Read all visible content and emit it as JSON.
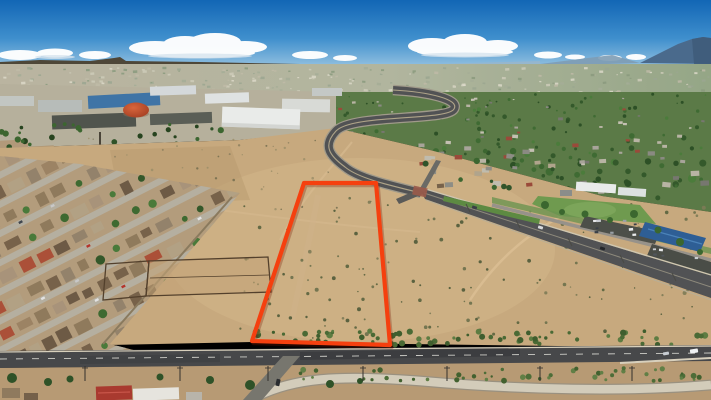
{
  "meta": {
    "description": "Aerial drone photograph of a vacant desert land parcel outlined in red, bordered by a residential neighborhood, industrial buildings, curving boulevards and a mountain on the horizon"
  },
  "colors": {
    "sky_top": "#1266b5",
    "sky_mid": "#3f8fcd",
    "sky_horizon": "#9cc6e2",
    "mountain": "#4a6a8c",
    "mountain_shade": "#3d5a78",
    "foothill": "#7e9cb4",
    "mesa": "#4e4738",
    "haze_left": "#b3ab92",
    "haze_right": "#879a74",
    "green_zone": "#5b7a47",
    "industrial_base": "#b6b09c",
    "dirt": "#c7a97e",
    "dirt_light": "#d5b88c",
    "below_dirt": "#b79a74",
    "road_main": "#47484a",
    "road_blvd": "#515254",
    "road_light": "#77766e",
    "median_green": "#5d8a42",
    "park_green": "#6f9a4f",
    "solar_blue": "#2e5e95",
    "dome_light": "#d8653c",
    "dome_dark": "#a03c20",
    "channel": "#d3ccba",
    "channel_edge": "#9a9180",
    "neighborhood_base": "#b39c7c",
    "wall": "#8a7a5e",
    "corral_fence": "#53402c",
    "red_outline": "#f5400f",
    "red_outline_shadow": "#7a1a05"
  },
  "parcel": {
    "points": "304,183 376,183 390,345 252,341",
    "stroke_width": 4.2
  },
  "neighborhood": {
    "seed": 7,
    "rows": 9,
    "v0": 176,
    "spacing": 26,
    "u0": -20,
    "u1": 310,
    "streetH": 6.5,
    "houseH": 13,
    "treeProb": 0.22,
    "carProb": 0.15,
    "street_color": "#b5afa0",
    "palette": [
      "#8f7a5c",
      "#9c8364",
      "#77624a",
      "#b2a184",
      "#6d5a45",
      "#a8937a",
      "#93826b",
      "#ab5038"
    ],
    "trees": [
      "#3e6a31",
      "#34582a",
      "#4a7a3a"
    ],
    "cars": [
      "#e2e2e2",
      "#b5342a",
      "#f0f0ee",
      "#40464e",
      "#c8c8c8"
    ]
  },
  "layers": [
    {
      "id": "city-specks",
      "kind": "rect",
      "seed": 11,
      "count": 230,
      "x": 0,
      "y": 68,
      "w": 711,
      "h": 26,
      "smin": 0.8,
      "smax": 2.2,
      "palette": [
        "#c9c5af",
        "#9aa287",
        "#b9b19a",
        "#7a8c6a",
        "#d9d5c1",
        "#8e9a80"
      ],
      "op": 0.85
    },
    {
      "id": "green-trees",
      "kind": "circle",
      "seed": 21,
      "count": 175,
      "x": 336,
      "y": 94,
      "w": 375,
      "h": 112,
      "smin": 1.1,
      "smax": 3.4,
      "palette": [
        "#3f6b33",
        "#34592b",
        "#4b7c3b",
        "#2d5026"
      ],
      "op": 1,
      "grow": true
    },
    {
      "id": "green-roofs",
      "kind": "rect",
      "seed": 31,
      "count": 85,
      "x": 340,
      "y": 98,
      "w": 371,
      "h": 104,
      "smin": 1.6,
      "smax": 3.6,
      "palette": [
        "#a8a49a",
        "#c4c0b2",
        "#8a8a82",
        "#9a4a3a",
        "#b8b4a4",
        "#777770"
      ],
      "op": 1,
      "grow": true
    },
    {
      "id": "ind-trees",
      "kind": "circle",
      "seed": 121,
      "count": 28,
      "x": 0,
      "y": 124,
      "w": 235,
      "h": 24,
      "smin": 1.4,
      "smax": 3.2,
      "palette": [
        "#2f5228",
        "#3c6630",
        "#27441f"
      ],
      "op": 1
    },
    {
      "id": "left-dirt-specks",
      "kind": "circle",
      "seed": 71,
      "count": 55,
      "x": 70,
      "y": 138,
      "w": 270,
      "h": 74,
      "smin": 0.5,
      "smax": 1.4,
      "palette": [
        "#8a7d5c",
        "#6f6a4c",
        "#9a8d68"
      ],
      "op": 0.8
    },
    {
      "id": "shrubs-main",
      "kind": "circle",
      "seed": 41,
      "count": 155,
      "x": 240,
      "y": 198,
      "w": 468,
      "h": 142,
      "smin": 0.6,
      "smax": 2.0,
      "palette": [
        "#6b704b",
        "#59633e",
        "#7d7b57",
        "#4f5a38"
      ],
      "op": 0.9
    },
    {
      "id": "shrub-line",
      "kind": "circle",
      "seed": 51,
      "count": 72,
      "x": 252,
      "y": 331,
      "w": 456,
      "h": 14,
      "smin": 1.4,
      "smax": 3.4,
      "palette": [
        "#4a6a35",
        "#3f5e2e",
        "#5d7c42"
      ],
      "op": 1
    },
    {
      "id": "shrubs-below",
      "kind": "circle",
      "seed": 61,
      "count": 48,
      "x": 298,
      "y": 368,
      "w": 410,
      "h": 13,
      "smin": 1.2,
      "smax": 3.0,
      "palette": [
        "#4d6d38",
        "#42612f",
        "#617f46"
      ],
      "op": 1
    },
    {
      "id": "mid-houses",
      "kind": "rect",
      "seed": 81,
      "count": 18,
      "x": 422,
      "y": 152,
      "w": 138,
      "h": 34,
      "smin": 2.2,
      "smax": 4.4,
      "palette": [
        "#9a4a3a",
        "#8d8d85",
        "#b0a48c",
        "#77624a",
        "#c0bcae"
      ],
      "op": 1
    },
    {
      "id": "mid-trees",
      "kind": "circle",
      "seed": 91,
      "count": 14,
      "x": 420,
      "y": 150,
      "w": 140,
      "h": 38,
      "smin": 1.5,
      "smax": 3.2,
      "palette": [
        "#3c6630",
        "#30542a"
      ],
      "op": 1
    },
    {
      "id": "park-cars",
      "kind": "rect",
      "seed": 101,
      "count": 9,
      "x": 588,
      "y": 220,
      "w": 62,
      "h": 16,
      "smin": 1.4,
      "smax": 2.2,
      "palette": [
        "#e8eaec",
        "#c8ccd0",
        "#3a4048",
        "#9aa0a6"
      ],
      "op": 1
    },
    {
      "id": "park-cars2",
      "kind": "rect",
      "seed": 103,
      "count": 6,
      "x": 652,
      "y": 248,
      "w": 52,
      "h": 16,
      "smin": 1.4,
      "smax": 2.0,
      "palette": [
        "#e8eaec",
        "#c8ccd0",
        "#51565c"
      ],
      "op": 1
    }
  ],
  "poles": [
    85,
    180,
    268,
    363,
    447,
    540,
    632
  ],
  "vehicles": [
    {
      "x": 690,
      "y": 349,
      "w": 8,
      "h": 4,
      "c": "#eef1f3",
      "a": -9
    },
    {
      "x": 663,
      "y": 352,
      "w": 6,
      "h": 3,
      "c": "#c8cdd2",
      "a": -9
    },
    {
      "x": 276,
      "y": 379,
      "w": 4,
      "h": 7,
      "c": "#2a2d30",
      "a": 12
    },
    {
      "x": 472,
      "y": 206,
      "w": 5,
      "h": 3,
      "c": "#3a3f45",
      "a": 17
    },
    {
      "x": 538,
      "y": 226,
      "w": 5,
      "h": 3,
      "c": "#d8dadc",
      "a": 17
    },
    {
      "x": 600,
      "y": 247,
      "w": 5,
      "h": 3,
      "c": "#23262a",
      "a": 17
    }
  ]
}
